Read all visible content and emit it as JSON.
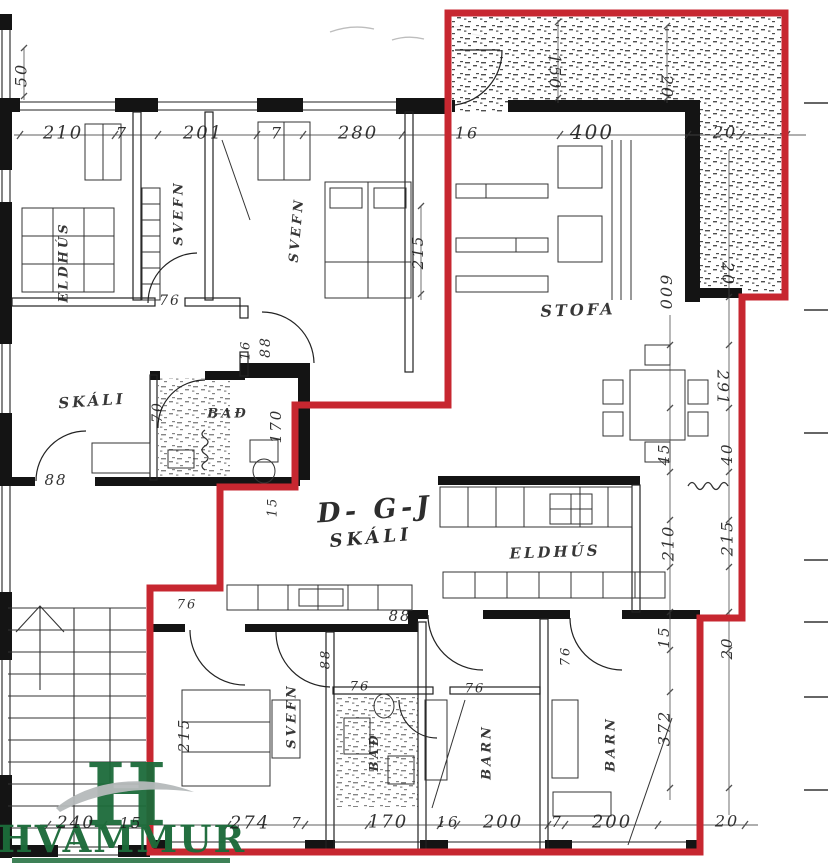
{
  "colors": {
    "outline_red": "#c72730",
    "wall_black": "#141414",
    "logo_green": "#1c6b3a",
    "logo_swoosh_gray": "#b5b9bb"
  },
  "logo": {
    "monogram": "H",
    "name": "HVAMMUR"
  },
  "labels": [
    {
      "name": "room-label-eldhus-left",
      "kind": "room",
      "text": "ELDHÚS",
      "x": 64,
      "y": 262,
      "rot": -90,
      "size": 13
    },
    {
      "name": "room-label-svefn-left",
      "kind": "room",
      "text": "SVEFN",
      "x": 179,
      "y": 213,
      "rot": -90,
      "size": 13
    },
    {
      "name": "room-label-svefn-mid",
      "kind": "room",
      "text": "SVEFN",
      "x": 297,
      "y": 230,
      "rot": -85,
      "size": 13
    },
    {
      "name": "room-label-skali-left",
      "kind": "room",
      "text": "SKÁLI",
      "x": 92,
      "y": 401,
      "rot": -4,
      "size": 15
    },
    {
      "name": "room-label-bad-left",
      "kind": "room",
      "text": "BAÐ",
      "x": 228,
      "y": 414,
      "rot": 0,
      "size": 13
    },
    {
      "name": "room-label-stofa",
      "kind": "room",
      "text": "STOFA",
      "x": 578,
      "y": 310,
      "rot": -2,
      "size": 16
    },
    {
      "name": "room-label-eldhus-center",
      "kind": "room",
      "text": "ELDHÚS",
      "x": 555,
      "y": 552,
      "rot": -2,
      "size": 15
    },
    {
      "name": "room-label-svefn-bottom",
      "kind": "room",
      "text": "SVEFN",
      "x": 292,
      "y": 716,
      "rot": -90,
      "size": 13
    },
    {
      "name": "room-label-bad-bottom",
      "kind": "room",
      "text": "BAÐ",
      "x": 374,
      "y": 752,
      "rot": -90,
      "size": 12
    },
    {
      "name": "room-label-barn-1",
      "kind": "room",
      "text": "BARN",
      "x": 487,
      "y": 752,
      "rot": -90,
      "size": 13
    },
    {
      "name": "room-label-barn-2",
      "kind": "room",
      "text": "BARN",
      "x": 611,
      "y": 744,
      "rot": -90,
      "size": 13
    },
    {
      "name": "unit-code",
      "kind": "unit",
      "text": "D- G-J",
      "x": 375,
      "y": 510,
      "rot": -4,
      "size": 27
    },
    {
      "name": "unit-skali",
      "kind": "unit",
      "text": "SKÁLI",
      "x": 371,
      "y": 538,
      "rot": -5,
      "size": 18
    },
    {
      "name": "dim-top-210",
      "kind": "dim",
      "text": "210",
      "x": 63,
      "y": 133,
      "rot": 0,
      "size": 18
    },
    {
      "name": "dim-top-7a",
      "kind": "dim",
      "text": "7",
      "x": 122,
      "y": 133,
      "rot": 0,
      "size": 16
    },
    {
      "name": "dim-top-201",
      "kind": "dim",
      "text": "201",
      "x": 203,
      "y": 133,
      "rot": 0,
      "size": 18
    },
    {
      "name": "dim-top-7b",
      "kind": "dim",
      "text": "7",
      "x": 277,
      "y": 133,
      "rot": 0,
      "size": 16
    },
    {
      "name": "dim-top-280",
      "kind": "dim",
      "text": "280",
      "x": 358,
      "y": 133,
      "rot": 0,
      "size": 18
    },
    {
      "name": "dim-top-16",
      "kind": "dim",
      "text": "16",
      "x": 467,
      "y": 133,
      "rot": 0,
      "size": 16
    },
    {
      "name": "dim-top-400",
      "kind": "dim",
      "text": "400",
      "x": 592,
      "y": 132,
      "rot": 0,
      "size": 20
    },
    {
      "name": "dim-top-20",
      "kind": "dim",
      "text": "20",
      "x": 725,
      "y": 132,
      "rot": 0,
      "size": 16
    },
    {
      "name": "dim-v-50",
      "kind": "dim",
      "text": "50",
      "x": 21,
      "y": 75,
      "rot": -90,
      "size": 16
    },
    {
      "name": "dim-v-150",
      "kind": "dim",
      "text": "150",
      "x": 555,
      "y": 72,
      "rot": 90,
      "size": 16
    },
    {
      "name": "dim-v-20a",
      "kind": "dim",
      "text": "20",
      "x": 667,
      "y": 87,
      "rot": 90,
      "size": 16
    },
    {
      "name": "dim-v-20b",
      "kind": "dim",
      "text": "20",
      "x": 728,
      "y": 274,
      "rot": 90,
      "size": 16
    },
    {
      "name": "dim-v-600",
      "kind": "dim",
      "text": "600",
      "x": 666,
      "y": 293,
      "rot": 90,
      "size": 16
    },
    {
      "name": "dim-v-291",
      "kind": "dim",
      "text": "291",
      "x": 723,
      "y": 388,
      "rot": 90,
      "size": 16
    },
    {
      "name": "dim-v-45",
      "kind": "dim",
      "text": "45",
      "x": 664,
      "y": 454,
      "rot": -90,
      "size": 15
    },
    {
      "name": "dim-v-40",
      "kind": "dim",
      "text": "40",
      "x": 727,
      "y": 454,
      "rot": -90,
      "size": 15
    },
    {
      "name": "dim-v-210",
      "kind": "dim",
      "text": "210",
      "x": 668,
      "y": 543,
      "rot": -90,
      "size": 16
    },
    {
      "name": "dim-v-215",
      "kind": "dim",
      "text": "215",
      "x": 727,
      "y": 538,
      "rot": -90,
      "size": 16
    },
    {
      "name": "dim-v-15",
      "kind": "dim",
      "text": "15",
      "x": 664,
      "y": 637,
      "rot": -90,
      "size": 15
    },
    {
      "name": "dim-v-20c",
      "kind": "dim",
      "text": "20",
      "x": 727,
      "y": 648,
      "rot": -90,
      "size": 15
    },
    {
      "name": "dim-v-372",
      "kind": "dim",
      "text": "372",
      "x": 664,
      "y": 728,
      "rot": -90,
      "size": 16
    },
    {
      "name": "dim-mid-76a",
      "kind": "dim",
      "text": "76",
      "x": 170,
      "y": 301,
      "rot": 0,
      "size": 14
    },
    {
      "name": "dim-mid-16",
      "kind": "dim",
      "text": "16",
      "x": 246,
      "y": 350,
      "rot": -90,
      "size": 13
    },
    {
      "name": "dim-mid-88a",
      "kind": "dim",
      "text": "88",
      "x": 266,
      "y": 347,
      "rot": -90,
      "size": 14
    },
    {
      "name": "dim-mid-215a",
      "kind": "dim",
      "text": "215",
      "x": 418,
      "y": 252,
      "rot": -90,
      "size": 15
    },
    {
      "name": "dim-mid-70",
      "kind": "dim",
      "text": "70",
      "x": 158,
      "y": 412,
      "rot": -90,
      "size": 14
    },
    {
      "name": "dim-mid-170",
      "kind": "dim",
      "text": "170",
      "x": 276,
      "y": 426,
      "rot": -90,
      "size": 15
    },
    {
      "name": "dim-mid-88b",
      "kind": "dim",
      "text": "88",
      "x": 56,
      "y": 480,
      "rot": 0,
      "size": 15
    },
    {
      "name": "dim-mid-15",
      "kind": "dim",
      "text": "15",
      "x": 273,
      "y": 507,
      "rot": -90,
      "size": 13
    },
    {
      "name": "dim-mid-88c",
      "kind": "dim",
      "text": "88",
      "x": 400,
      "y": 616,
      "rot": 0,
      "size": 15
    },
    {
      "name": "dim-mid-76b",
      "kind": "dim",
      "text": "76",
      "x": 187,
      "y": 605,
      "rot": 0,
      "size": 13
    },
    {
      "name": "dim-mid-88d",
      "kind": "dim",
      "text": "88",
      "x": 326,
      "y": 659,
      "rot": -90,
      "size": 13
    },
    {
      "name": "dim-mid-215b",
      "kind": "dim",
      "text": "215",
      "x": 184,
      "y": 735,
      "rot": -90,
      "size": 15
    },
    {
      "name": "dim-mid-76c",
      "kind": "dim",
      "text": "76",
      "x": 360,
      "y": 687,
      "rot": 0,
      "size": 13
    },
    {
      "name": "dim-mid-76d",
      "kind": "dim",
      "text": "76",
      "x": 475,
      "y": 689,
      "rot": 0,
      "size": 13
    },
    {
      "name": "dim-mid-76e",
      "kind": "dim",
      "text": "76",
      "x": 566,
      "y": 656,
      "rot": -90,
      "size": 13
    },
    {
      "name": "dim-bot-240",
      "kind": "dim",
      "text": "240",
      "x": 76,
      "y": 823,
      "rot": 0,
      "size": 17
    },
    {
      "name": "dim-bot-15",
      "kind": "dim",
      "text": "15",
      "x": 131,
      "y": 823,
      "rot": 0,
      "size": 15
    },
    {
      "name": "dim-bot-274",
      "kind": "dim",
      "text": "274",
      "x": 250,
      "y": 823,
      "rot": 0,
      "size": 18
    },
    {
      "name": "dim-bot-7a",
      "kind": "dim",
      "text": "7",
      "x": 297,
      "y": 823,
      "rot": 0,
      "size": 15
    },
    {
      "name": "dim-bot-170",
      "kind": "dim",
      "text": "170",
      "x": 388,
      "y": 822,
      "rot": 0,
      "size": 18
    },
    {
      "name": "dim-bot-16",
      "kind": "dim",
      "text": "16",
      "x": 448,
      "y": 822,
      "rot": 0,
      "size": 15
    },
    {
      "name": "dim-bot-200a",
      "kind": "dim",
      "text": "200",
      "x": 503,
      "y": 822,
      "rot": 0,
      "size": 18
    },
    {
      "name": "dim-bot-7b",
      "kind": "dim",
      "text": "7",
      "x": 557,
      "y": 822,
      "rot": 0,
      "size": 15
    },
    {
      "name": "dim-bot-200b",
      "kind": "dim",
      "text": "200",
      "x": 612,
      "y": 822,
      "rot": 0,
      "size": 18
    },
    {
      "name": "dim-bot-20",
      "kind": "dim",
      "text": "20",
      "x": 727,
      "y": 821,
      "rot": 0,
      "size": 16
    }
  ]
}
